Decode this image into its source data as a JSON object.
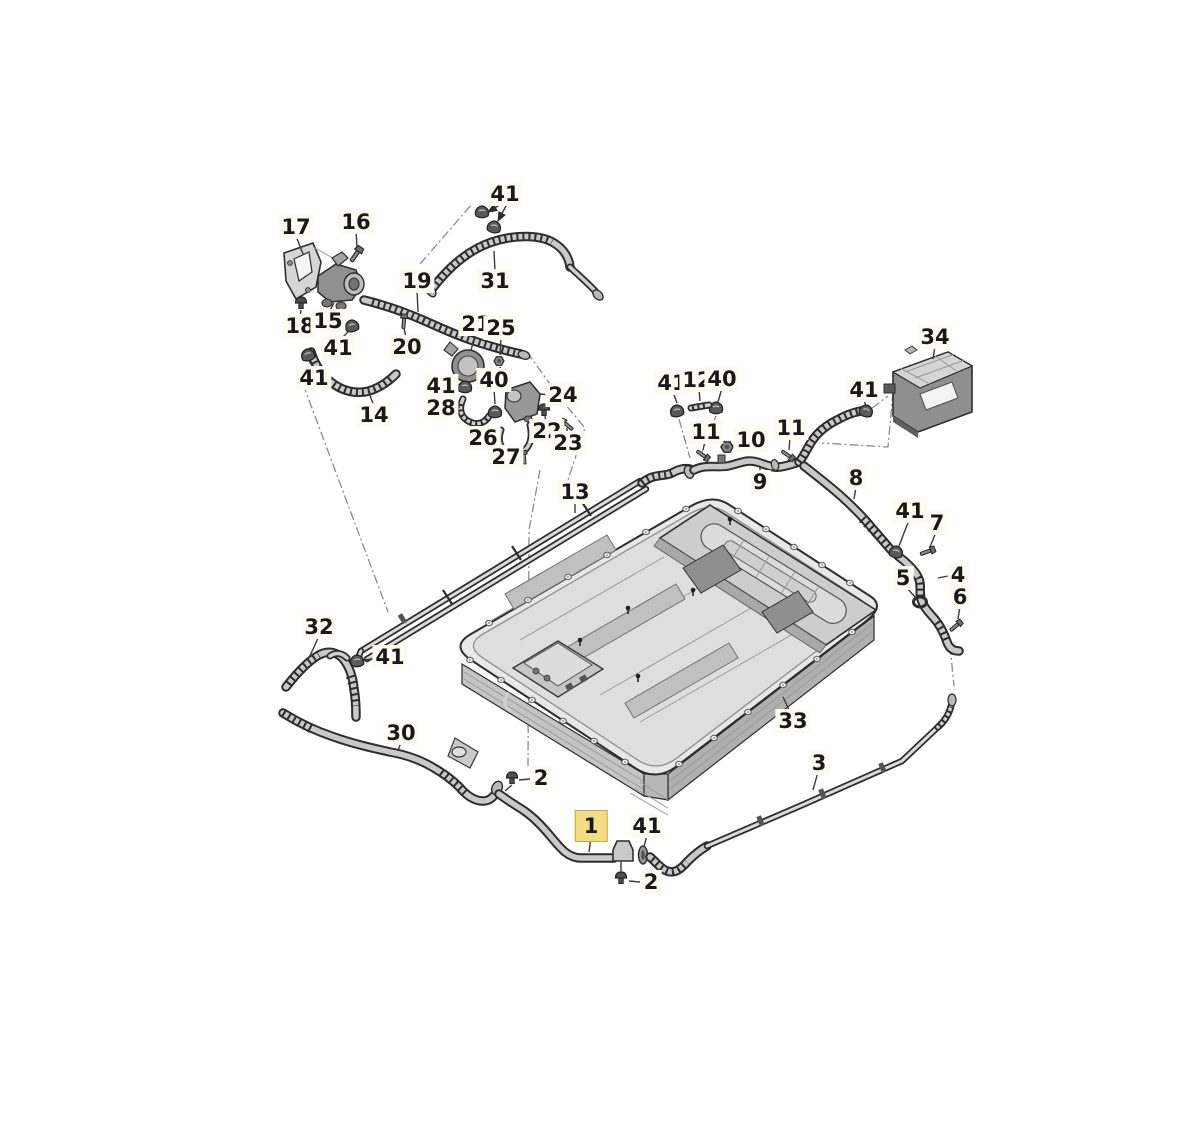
{
  "diagram": {
    "type": "exploded-parts-diagram",
    "subject": "hv-battery-cooling-circuit",
    "selected_part": "1",
    "colors": {
      "highlight_bg": "#f3dc82",
      "highlight_border": "#c7a53e",
      "label_bg": "#fdfbf1",
      "line": "#2d2d2d"
    },
    "labels": [
      {
        "part": "17",
        "x": 296,
        "y": 227,
        "selected": false
      },
      {
        "part": "16",
        "x": 356,
        "y": 222,
        "selected": false
      },
      {
        "part": "41",
        "x": 505,
        "y": 194,
        "selected": false
      },
      {
        "part": "19",
        "x": 417,
        "y": 281,
        "selected": false
      },
      {
        "part": "31",
        "x": 495,
        "y": 281,
        "selected": false
      },
      {
        "part": "18",
        "x": 300,
        "y": 326,
        "selected": false
      },
      {
        "part": "15",
        "x": 328,
        "y": 321,
        "selected": false
      },
      {
        "part": "41",
        "x": 338,
        "y": 348,
        "selected": false
      },
      {
        "part": "20",
        "x": 407,
        "y": 347,
        "selected": false
      },
      {
        "part": "21",
        "x": 476,
        "y": 324,
        "selected": false
      },
      {
        "part": "25",
        "x": 501,
        "y": 328,
        "selected": false
      },
      {
        "part": "41",
        "x": 314,
        "y": 378,
        "selected": false
      },
      {
        "part": "14",
        "x": 374,
        "y": 415,
        "selected": false
      },
      {
        "part": "41",
        "x": 441,
        "y": 386,
        "selected": false
      },
      {
        "part": "40",
        "x": 494,
        "y": 380,
        "selected": false
      },
      {
        "part": "28",
        "x": 441,
        "y": 408,
        "selected": false
      },
      {
        "part": "24",
        "x": 563,
        "y": 395,
        "selected": false
      },
      {
        "part": "22",
        "x": 547,
        "y": 431,
        "selected": false
      },
      {
        "part": "23",
        "x": 568,
        "y": 443,
        "selected": false
      },
      {
        "part": "26",
        "x": 483,
        "y": 438,
        "selected": false
      },
      {
        "part": "27",
        "x": 506,
        "y": 457,
        "selected": false
      },
      {
        "part": "13",
        "x": 575,
        "y": 492,
        "selected": false
      },
      {
        "part": "34",
        "x": 935,
        "y": 337,
        "selected": false
      },
      {
        "part": "41",
        "x": 672,
        "y": 383,
        "selected": false
      },
      {
        "part": "12",
        "x": 697,
        "y": 380,
        "selected": false
      },
      {
        "part": "40",
        "x": 722,
        "y": 379,
        "selected": false
      },
      {
        "part": "41",
        "x": 864,
        "y": 390,
        "selected": false
      },
      {
        "part": "11",
        "x": 706,
        "y": 432,
        "selected": false
      },
      {
        "part": "10",
        "x": 751,
        "y": 440,
        "selected": false
      },
      {
        "part": "11",
        "x": 791,
        "y": 428,
        "selected": false
      },
      {
        "part": "9",
        "x": 760,
        "y": 482,
        "selected": false
      },
      {
        "part": "8",
        "x": 856,
        "y": 478,
        "selected": false
      },
      {
        "part": "41",
        "x": 910,
        "y": 511,
        "selected": false
      },
      {
        "part": "7",
        "x": 937,
        "y": 523,
        "selected": false
      },
      {
        "part": "5",
        "x": 903,
        "y": 578,
        "selected": false
      },
      {
        "part": "4",
        "x": 958,
        "y": 575,
        "selected": false
      },
      {
        "part": "6",
        "x": 960,
        "y": 597,
        "selected": false
      },
      {
        "part": "33",
        "x": 793,
        "y": 721,
        "selected": false
      },
      {
        "part": "32",
        "x": 319,
        "y": 627,
        "selected": false
      },
      {
        "part": "41",
        "x": 390,
        "y": 657,
        "selected": false
      },
      {
        "part": "30",
        "x": 401,
        "y": 733,
        "selected": false
      },
      {
        "part": "2",
        "x": 541,
        "y": 778,
        "selected": false
      },
      {
        "part": "3",
        "x": 819,
        "y": 763,
        "selected": false
      },
      {
        "part": "1",
        "x": 591,
        "y": 826,
        "selected": true
      },
      {
        "part": "41",
        "x": 647,
        "y": 826,
        "selected": false
      },
      {
        "part": "2",
        "x": 651,
        "y": 882,
        "selected": false
      }
    ]
  }
}
